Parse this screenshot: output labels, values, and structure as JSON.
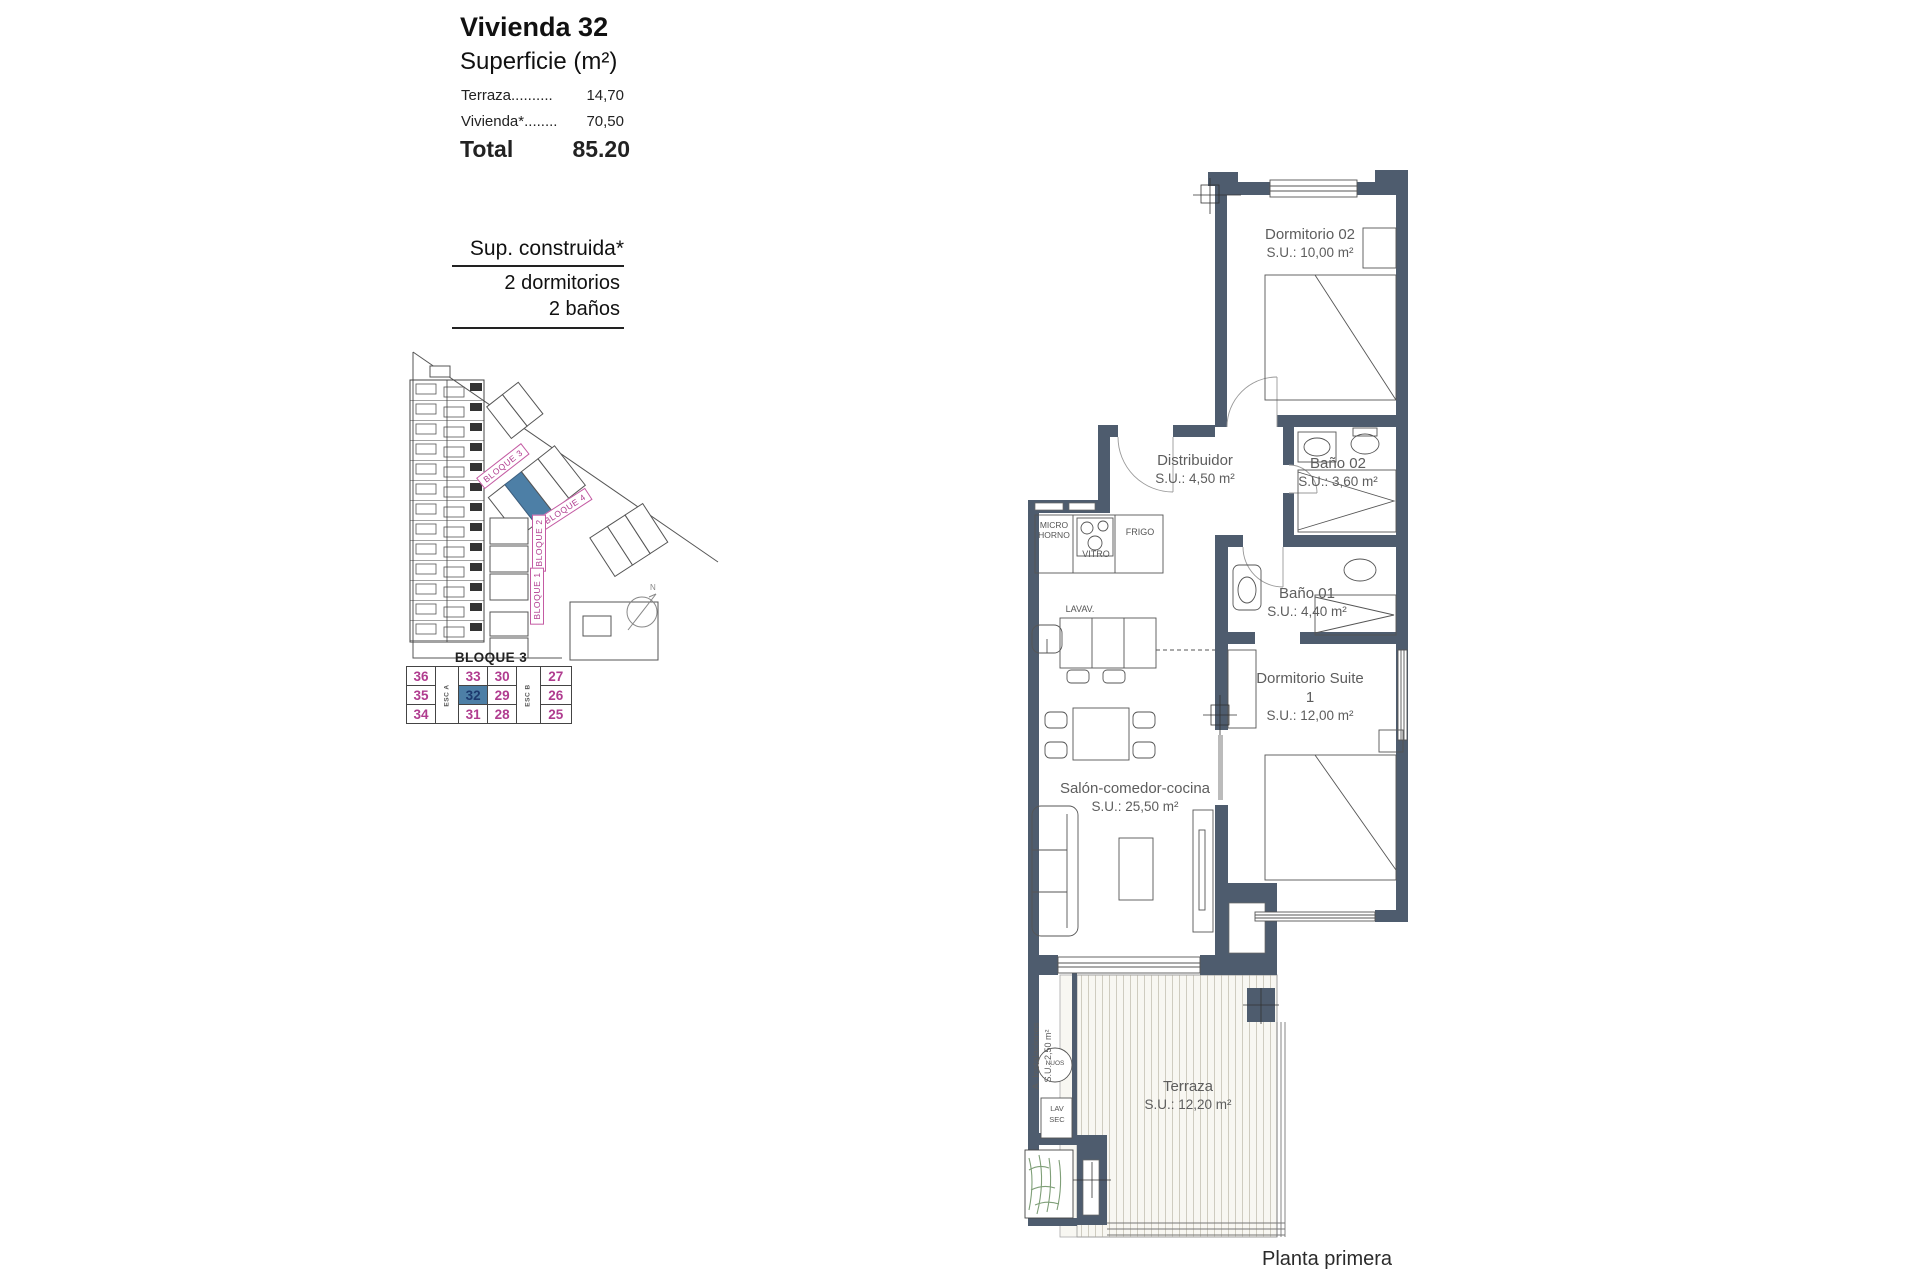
{
  "info": {
    "title": "Vivienda 32",
    "subtitle": "Superficie (m²)",
    "rows": [
      {
        "label": "Terraza..........",
        "value": "14,70"
      },
      {
        "label": "Vivienda*........",
        "value": "70,50"
      }
    ],
    "total_label": "Total",
    "total_value": "85.20",
    "summary": [
      "Sup. construida*",
      "2 dormitorios",
      "2 baños"
    ]
  },
  "site_plan": {
    "block_labels": [
      "BLOQUE 3",
      "BLOQUE 4",
      "BLOQUE 2",
      "BLOQUE 1"
    ],
    "north": "N",
    "highlight_color": "#4d7fa6",
    "label_color": "#b03c8f"
  },
  "unit_table": {
    "title": "BLOQUE 3",
    "stair_a": "ESC A",
    "stair_b": "ESC B",
    "rows": [
      [
        "36",
        "33",
        "30",
        "27"
      ],
      [
        "35",
        "32",
        "29",
        "26"
      ],
      [
        "34",
        "31",
        "28",
        "25"
      ]
    ],
    "selected_unit": "32",
    "number_color": "#b03c8f",
    "selected_bg": "#4d7fa6",
    "selected_text": "#1d3a6e"
  },
  "floor_plan": {
    "rooms": {
      "dormitorio02": {
        "name": "Dormitorio 02",
        "area": "S.U.: 10,00 m²"
      },
      "distribuidor": {
        "name": "Distribuidor",
        "area": "S.U.: 4,50 m²"
      },
      "bano02": {
        "name": "Baño 02",
        "area": "S.U.: 3,60 m²"
      },
      "bano01": {
        "name": "Baño 01",
        "area": "S.U.: 4,40 m²"
      },
      "suite": {
        "name": "Dormitorio Suite 1",
        "area": "S.U.: 12,00 m²"
      },
      "salon": {
        "name": "Salón-comedor-cocina",
        "area": "S.U.: 25,50 m²"
      },
      "instalaciones": {
        "name": "A. Instalaciones",
        "area": "S.U.: 2,50 m²"
      },
      "terraza": {
        "name": "Terraza",
        "area": "S.U.: 12,20 m²"
      }
    },
    "fixtures": {
      "micro": "MICRO HORNO",
      "vitro": "VITRO",
      "frigo": "FRIGO",
      "lavav": "LAVAV.",
      "nuos": "NUOS",
      "lav": "LAV",
      "sec": "SEC"
    },
    "wall_color": "#4e5c6e"
  },
  "footer": {
    "floor_label": "Planta primera"
  }
}
